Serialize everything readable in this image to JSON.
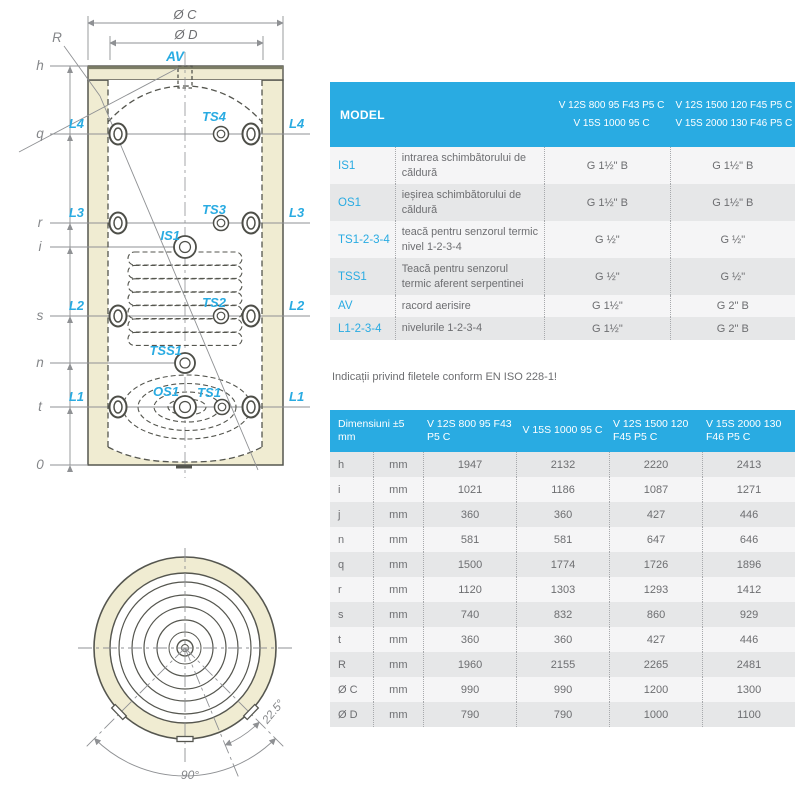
{
  "colors": {
    "accent_blue": "#29abe2",
    "insulation_cream": "#f0ecd2",
    "row_gray": "#e6e7e8",
    "line_dark": "#55564f",
    "text_gray": "#6d6e71"
  },
  "diagram": {
    "av": "AV",
    "l4": "L4",
    "l3": "L3",
    "l2": "L2",
    "l1": "L1",
    "ts4": "TS4",
    "ts3": "TS3",
    "ts2": "TS2",
    "ts1": "TS1",
    "is1": "IS1",
    "tss1": "TSS1",
    "os1": "OS1",
    "dim_h": "h",
    "dim_q": "q",
    "dim_r": "r",
    "dim_i": "i",
    "dim_s": "s",
    "dim_n": "n",
    "dim_t": "t",
    "dim_zero": "0",
    "dia_c": "Ø C",
    "dia_d": "Ø D",
    "radius": "R",
    "angle_small": "22.5°",
    "angle_large": "90°"
  },
  "model_table": {
    "header": {
      "model": "MODEL",
      "col1_line1": "V 12S 800 95 F43 P5 C",
      "col1_line2": "V 15S 1000 95 C",
      "col2_line1": "V 12S 1500 120 F45 P5 C",
      "col2_line2": "V 15S 2000 130 F46 P5 C"
    },
    "rows": [
      {
        "code": "IS1",
        "desc": "intrarea schimbătorului de căldură",
        "v1": "G 1½\" B",
        "v2": "G 1½\" B"
      },
      {
        "code": "OS1",
        "desc": "ieșirea schimbătorului de căldură",
        "v1": "G 1½\" B",
        "v2": "G 1½\" B"
      },
      {
        "code": "TS1-2-3-4",
        "desc": "teacă pentru senzorul termic nivel 1-2-3-4",
        "v1": "G ½\"",
        "v2": "G ½\""
      },
      {
        "code": "TSS1",
        "desc": "Teacă pentru senzorul termic aferent serpentinei",
        "v1": "G ½\"",
        "v2": "G ½\""
      },
      {
        "code": "AV",
        "desc": "racord aerisire",
        "v1": "G 1½\"",
        "v2": "G 2\" B"
      },
      {
        "code": "L1-2-3-4",
        "desc": "nivelurile 1-2-3-4",
        "v1": "G 1½\"",
        "v2": "G 2\" B"
      }
    ]
  },
  "note": "Indicații privind filetele conform EN ISO 228-1!",
  "dim_table": {
    "title": "Dimensiuni ±5 mm",
    "unit": "mm",
    "columns": [
      "V 12S 800 95 F43 P5 C",
      "V 15S 1000 95 C",
      "V 12S 1500 120 F45 P5 C",
      "V 15S 2000 130 F46 P5 C"
    ],
    "rows": [
      {
        "dim": "h",
        "values": [
          "1947",
          "2132",
          "2220",
          "2413"
        ]
      },
      {
        "dim": "i",
        "values": [
          "1021",
          "1186",
          "1087",
          "1271"
        ]
      },
      {
        "dim": "j",
        "values": [
          "360",
          "360",
          "427",
          "446"
        ]
      },
      {
        "dim": "n",
        "values": [
          "581",
          "581",
          "647",
          "646"
        ]
      },
      {
        "dim": "q",
        "values": [
          "1500",
          "1774",
          "1726",
          "1896"
        ]
      },
      {
        "dim": "r",
        "values": [
          "1120",
          "1303",
          "1293",
          "1412"
        ]
      },
      {
        "dim": "s",
        "values": [
          "740",
          "832",
          "860",
          "929"
        ]
      },
      {
        "dim": "t",
        "values": [
          "360",
          "360",
          "427",
          "446"
        ]
      },
      {
        "dim": "R",
        "values": [
          "1960",
          "2155",
          "2265",
          "2481"
        ]
      },
      {
        "dim": "Ø C",
        "values": [
          "990",
          "990",
          "1200",
          "1300"
        ]
      },
      {
        "dim": "Ø D",
        "values": [
          "790",
          "790",
          "1000",
          "1100"
        ]
      }
    ]
  }
}
